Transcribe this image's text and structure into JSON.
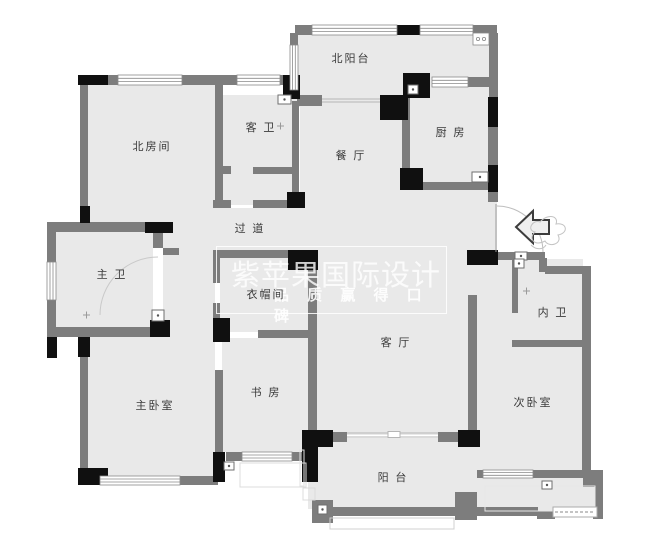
{
  "watermark": {
    "line1": "紫苹果国际设计",
    "line2": "品 质 赢 得 口 碑"
  },
  "rooms": [
    {
      "name": "北阳台",
      "x": 351,
      "y": 58
    },
    {
      "name": "北房间",
      "x": 152,
      "y": 146
    },
    {
      "name": "客 卫",
      "x": 261,
      "y": 127
    },
    {
      "name": "厨 房",
      "x": 451,
      "y": 132
    },
    {
      "name": "餐 厅",
      "x": 351,
      "y": 155
    },
    {
      "name": "过 道",
      "x": 250,
      "y": 228
    },
    {
      "name": "主 卫",
      "x": 112,
      "y": 274
    },
    {
      "name": "衣帽间",
      "x": 266,
      "y": 294
    },
    {
      "name": "客 厅",
      "x": 396,
      "y": 342
    },
    {
      "name": "书 房",
      "x": 266,
      "y": 392
    },
    {
      "name": "主卧室",
      "x": 155,
      "y": 405
    },
    {
      "name": "次卧室",
      "x": 533,
      "y": 402
    },
    {
      "name": "内 卫",
      "x": 553,
      "y": 312
    },
    {
      "name": "阳 台",
      "x": 393,
      "y": 477
    }
  ],
  "entrance": {
    "arrow_direction": "left"
  },
  "colors": {
    "wall": "#7d7d7d",
    "pier": "#101010",
    "floor": "#e9e9e9",
    "background": "#ffffff",
    "label": "#3a3a3a",
    "watermark": "rgba(255,255,255,0.8)"
  }
}
